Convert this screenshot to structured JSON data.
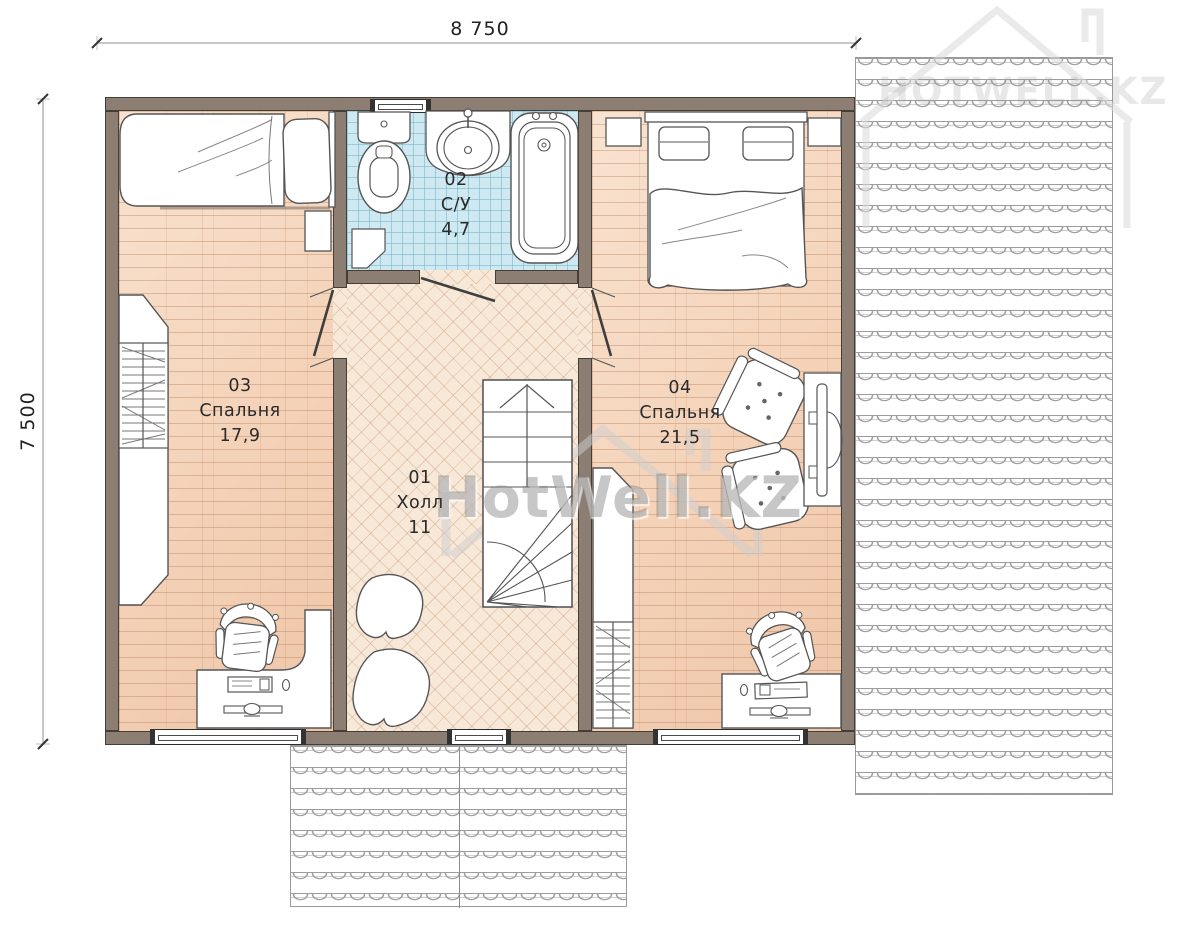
{
  "plan": {
    "dimensions": {
      "width_label": "8 750",
      "height_label": "7 500"
    },
    "rooms": [
      {
        "number": "01",
        "name": "Холл",
        "area": "11"
      },
      {
        "number": "02",
        "name": "С/У",
        "area": "4,7"
      },
      {
        "number": "03",
        "name": "Спальня",
        "area": "17,9"
      },
      {
        "number": "04",
        "name": "Спальня",
        "area": "21,5"
      }
    ],
    "watermark": {
      "center": "HotWell.KZ",
      "top_right": "HOTWELL.KZ"
    },
    "colors": {
      "wall": "#8d7e74",
      "wood_floor": "#f5d7bf",
      "herringbone_floor": "#f8e8d8",
      "tile_floor": "#cfe9f2",
      "roof_line": "#9a9a9a",
      "label_text": "#2b2b2b"
    }
  }
}
